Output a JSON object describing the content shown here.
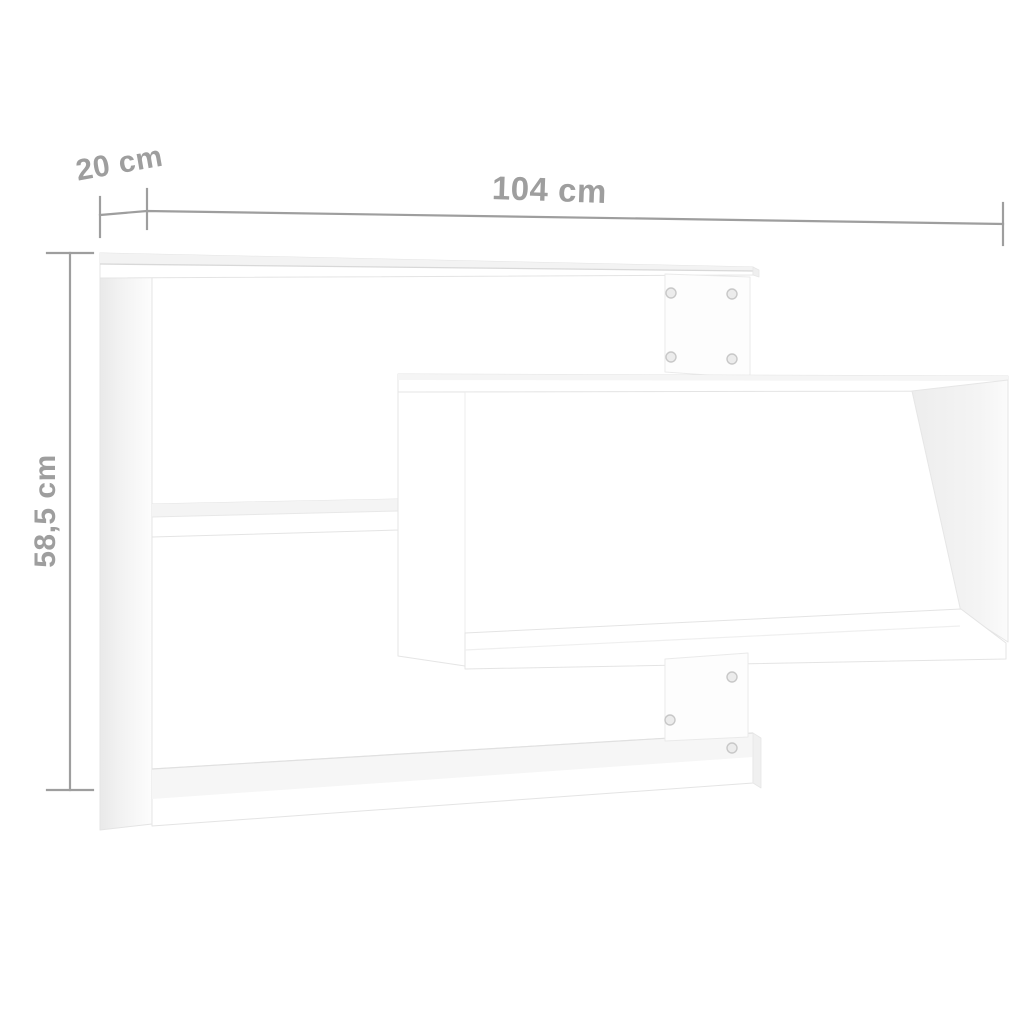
{
  "diagram": {
    "background_color": "#ffffff",
    "annotation_color": "#9e9e9e",
    "shelf_color": "#ffffff",
    "dimensions": {
      "width": {
        "label": "104 cm",
        "value_cm": 104
      },
      "depth": {
        "label": "20 cm",
        "value_cm": 20
      },
      "height": {
        "label": "58,5 cm",
        "value_cm": 58.5
      }
    },
    "screw_count": 7
  }
}
